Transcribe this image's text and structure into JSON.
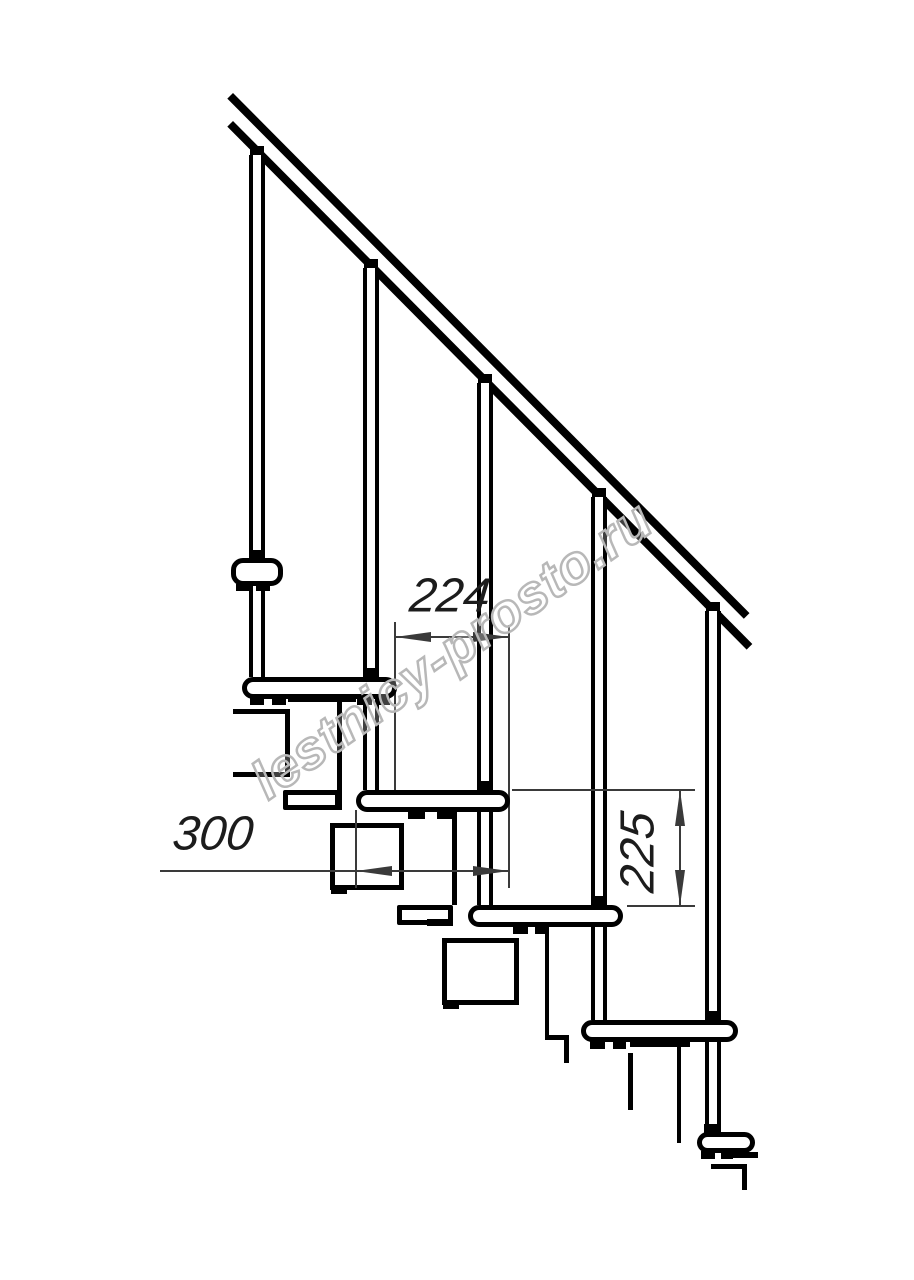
{
  "title": "Modular staircase side-view technical drawing",
  "watermark": {
    "text": "lestnicy-prosto.ru"
  },
  "dimensions": {
    "going_mm": "224",
    "tread_depth_mm": "300",
    "rise_mm": "225"
  },
  "colors": {
    "line": "#000000",
    "dimension_line": "#3a3a3a",
    "watermark_outline": "#b8b8b8",
    "background": "#ffffff"
  }
}
